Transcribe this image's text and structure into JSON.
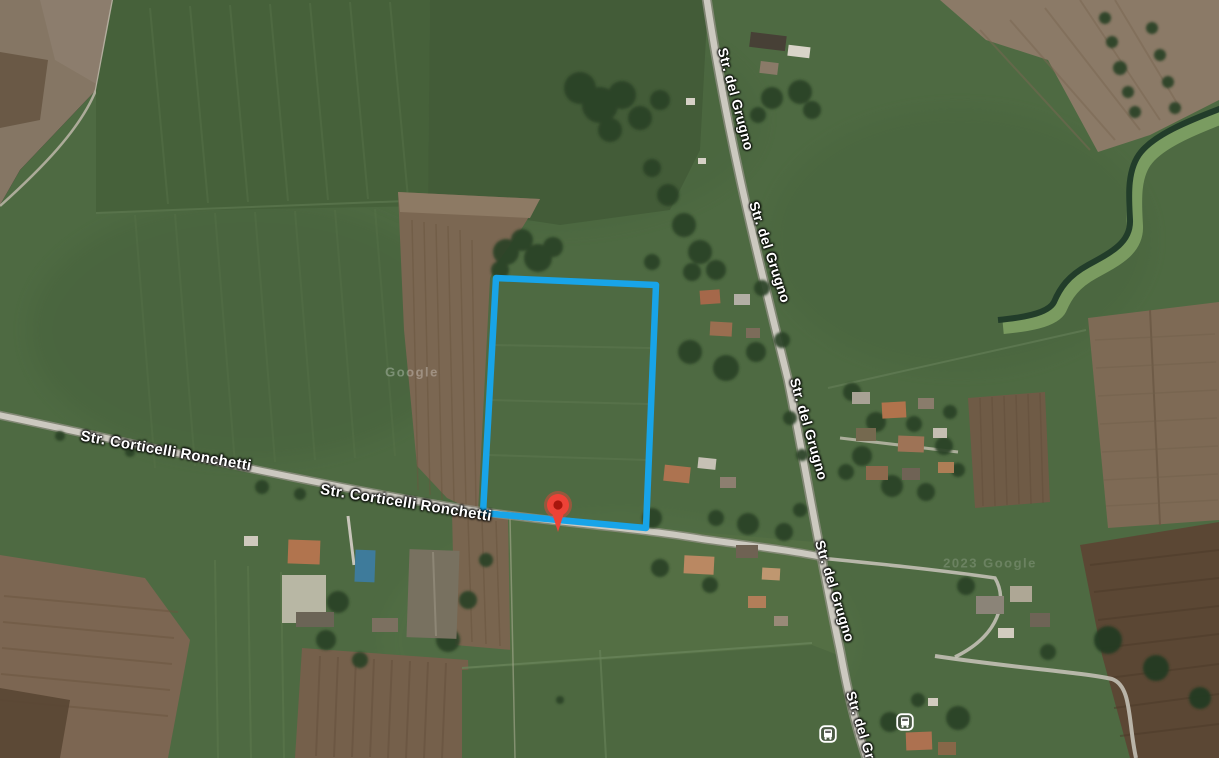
{
  "map": {
    "view_type": "satellite",
    "road_labels": [
      {
        "road": "corticelli",
        "text": "Str. Corticelli Ronchetti",
        "x": 166,
        "y": 451,
        "rotation": 10,
        "size": 15
      },
      {
        "road": "corticelli",
        "text": "Str. Corticelli Ronchetti",
        "x": 406,
        "y": 503,
        "rotation": 9,
        "size": 15
      },
      {
        "road": "grugno",
        "text": "Str. del Grugno",
        "x": 736,
        "y": 99,
        "rotation": 75,
        "size": 14
      },
      {
        "road": "grugno",
        "text": "Str. del Grugno",
        "x": 770,
        "y": 252,
        "rotation": 72,
        "size": 14
      },
      {
        "road": "grugno",
        "text": "Str. del Grugno",
        "x": 809,
        "y": 429,
        "rotation": 74,
        "size": 14
      },
      {
        "road": "grugno",
        "text": "Str. del Grugno",
        "x": 835,
        "y": 591,
        "rotation": 73,
        "size": 14
      },
      {
        "road": "grugno",
        "text": "Str. del Grugno",
        "x": 866,
        "y": 742,
        "rotation": 73,
        "size": 14
      }
    ],
    "watermarks": [
      {
        "text": "Google",
        "x": 412,
        "y": 372,
        "opacity": 0.28
      },
      {
        "text": "2023 Google",
        "x": 990,
        "y": 563,
        "opacity": 0.16
      }
    ],
    "parcel": {
      "stroke": "#18a4e8",
      "stroke_width": 6.5,
      "points": [
        [
          496,
          278
        ],
        [
          656,
          285
        ],
        [
          646,
          528
        ],
        [
          483,
          513
        ]
      ]
    },
    "marker": {
      "x": 558,
      "y": 505,
      "color": "#ee4237",
      "inner_color": "#a8160d"
    },
    "transit_stops": [
      {
        "x": 828,
        "y": 734
      },
      {
        "x": 905,
        "y": 722
      }
    ],
    "colors": {
      "field_green": "#4e6a42",
      "field_green_dark": "#445e39",
      "hedge_green": "#2b4227",
      "plow_brown": "#7b6752",
      "plow_dark_brown": "#5b4734",
      "road_gray": "#ccc9c0",
      "canal_dark": "#223d2a",
      "canal_bank": "#82a566",
      "parcel_blue": "#18a4e8",
      "marker_red": "#ee4237",
      "label_text": "#ffffff"
    }
  }
}
